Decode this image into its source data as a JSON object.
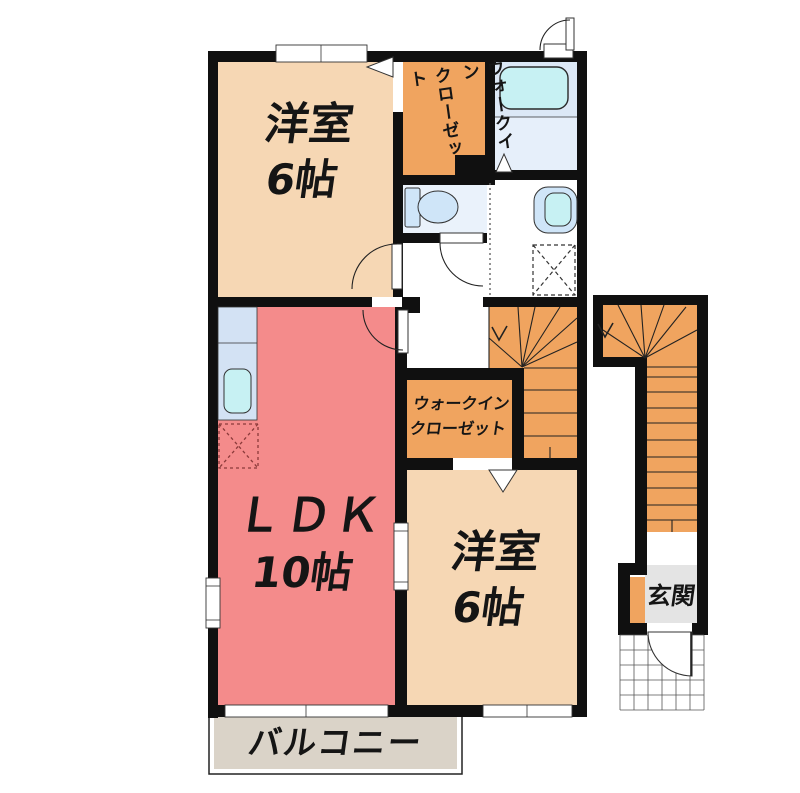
{
  "floorplan": {
    "rooms": {
      "bedroom_top": {
        "label": "洋室",
        "size": "6帖"
      },
      "walk_in_closet_top": {
        "label_line1": "ウォークイン",
        "label_line2": "クローゼット"
      },
      "ldk": {
        "label": "ＬＤＫ",
        "size": "10帖"
      },
      "walk_in_closet_mid": {
        "label_line1": "ウォークイン",
        "label_line2": "クローゼット"
      },
      "bedroom_bottom": {
        "label": "洋室",
        "size": "6帖"
      },
      "entrance": {
        "label": "玄関"
      },
      "balcony": {
        "label": "バルコニー"
      }
    },
    "colors": {
      "wall": "#101010",
      "bedroom": "#f6d7b4",
      "closet_stairs": "#f0a45f",
      "ldk": "#f48b8b",
      "bath": "#dce8f6",
      "bath_washing": "#e6effa",
      "fixture_water": "#c7f1f3",
      "toilet_room": "#eaf2fb",
      "fixture_blue": "#cfe5f8",
      "kitchen_counter": "#d3e2f4",
      "genkan": "#e4e4e4",
      "balcony": "#dad3c8"
    }
  }
}
